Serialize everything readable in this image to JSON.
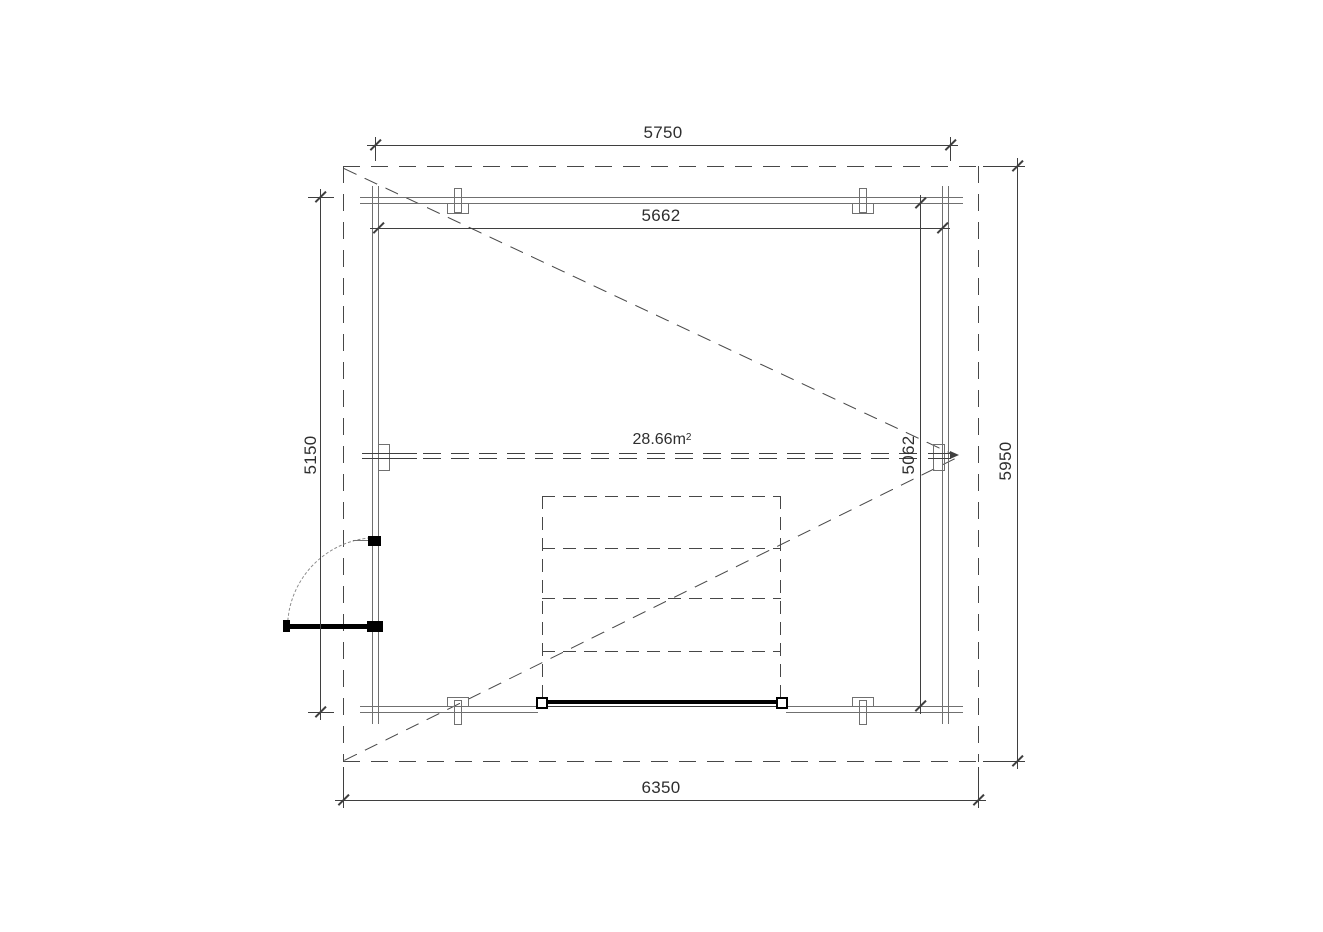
{
  "colors": {
    "bg": "#ffffff",
    "line": "#3f3f3f",
    "wall": "#707070",
    "dash": "#474747",
    "ink": "#000000",
    "text": "#2e2e2e"
  },
  "plan": {
    "area": {
      "value": "28.66m",
      "sup": "2"
    },
    "dims": {
      "roof_width": "6350",
      "roof_depth": "5950",
      "wall_outer_width": "5750",
      "wall_outer_depth": "5150",
      "interior_width": "5662",
      "interior_depth": "5062"
    }
  }
}
